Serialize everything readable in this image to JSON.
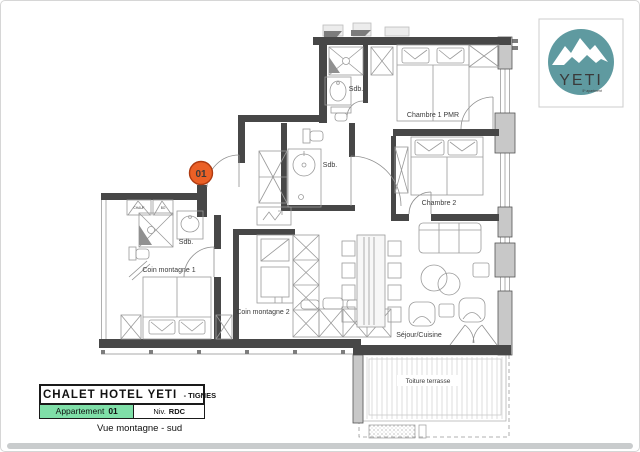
{
  "logo": {
    "text": "YETI",
    "tagline": "5* apartment"
  },
  "marker": {
    "label": "01"
  },
  "rooms": {
    "sdb1": "Sdb.",
    "sdb2": "Sdb.",
    "sdb3": "Sdb.",
    "chambre1": "Chambre 1 PMR",
    "chambre2": "Chambre 2",
    "coin1": "Coin montagne 1",
    "coin2": "Coin montagne 2",
    "sejour": "Séjour/Cuisine",
    "terrasse": "Toiture terrasse",
    "closet1": "CHAUF",
    "closet2": "BO"
  },
  "title_block": {
    "name": "CHALET HOTEL YETI",
    "suffix": "- TIGNES",
    "apartment_label": "Appartement",
    "apartment_number": "01",
    "level_label": "Niv.",
    "level_value": "RDC",
    "caption": "Vue montagne - sud"
  },
  "colors": {
    "logo_teal": "#5f9aa0",
    "marker_orange": "#eb6026",
    "apartment_green": "#7fdfa8",
    "wall_dark": "#474747",
    "wall_gray": "#c8c8c8"
  }
}
